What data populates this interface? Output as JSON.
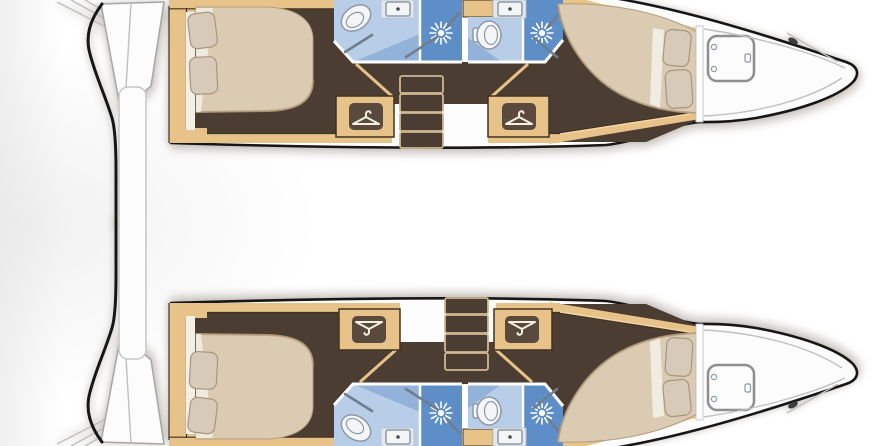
{
  "diagram": {
    "title": "Catamaran yacht layout plan — top view, 4 cabins / 4 heads",
    "type": "boat-floor-plan",
    "orientation": "bows to the right, transoms to the left"
  },
  "colors": {
    "hull_outline": "#161616",
    "deck_white": "#fcfcfc",
    "deck_line": "#bfbfbf",
    "transom_line": "#a6a6a6",
    "wood": "#e7c289",
    "wood_light": "#f2d8a8",
    "wood_edge": "#40321f",
    "floor": "#4c3d33",
    "bed": "#dbcbb3",
    "bed_edge": "#b49d7c",
    "pillow": "#d8cab9",
    "pillow_edge": "#a8977f",
    "linen": "#f3efe5",
    "bath_floor": "#b8cde7",
    "bath_mid": "#93b2d9",
    "shower": "#5e8ec7",
    "fixture": "#f3f5f7",
    "fixture_line": "#8d99a6",
    "wall": "#ffffff",
    "icon_plate": "#5a4a3e",
    "icon_glyph": "#f6f0e0",
    "stairs_line": "#cdb891",
    "rod": "#6f7e8d"
  },
  "legend": {
    "shower_icon": "sunburst shower head",
    "wardrobe_icon": "clothes hanger",
    "hatch_icon": "rounded-square deck hatch"
  },
  "hulls": [
    {
      "id": "port-hull",
      "position": "top",
      "features": {
        "stern": "transom platform with steps",
        "aft_cabin": "double berth with 2 pillows",
        "aft_head": "toilet, washbasin, shower stall",
        "forward_head": "toilet, washbasin, shower stall",
        "wardrobes": [
          "aft wardrobe",
          "forward wardrobe"
        ],
        "companionway": "4 steps down",
        "forward_cabin": "double berth with 2 pillows",
        "foredeck": "deck hatch, cleat"
      }
    },
    {
      "id": "starboard-hull",
      "position": "bottom",
      "features": {
        "stern": "transom platform with steps",
        "aft_cabin": "double berth with 2 pillows",
        "aft_head": "toilet, washbasin, shower stall",
        "forward_head": "toilet, washbasin, shower stall",
        "wardrobes": [
          "aft wardrobe",
          "forward wardrobe"
        ],
        "companionway": "4 steps down",
        "forward_cabin": "double berth with 2 pillows",
        "foredeck": "deck hatch, cleat"
      }
    }
  ],
  "between_hulls": {
    "element": "aft crossbeam / platform bar"
  }
}
